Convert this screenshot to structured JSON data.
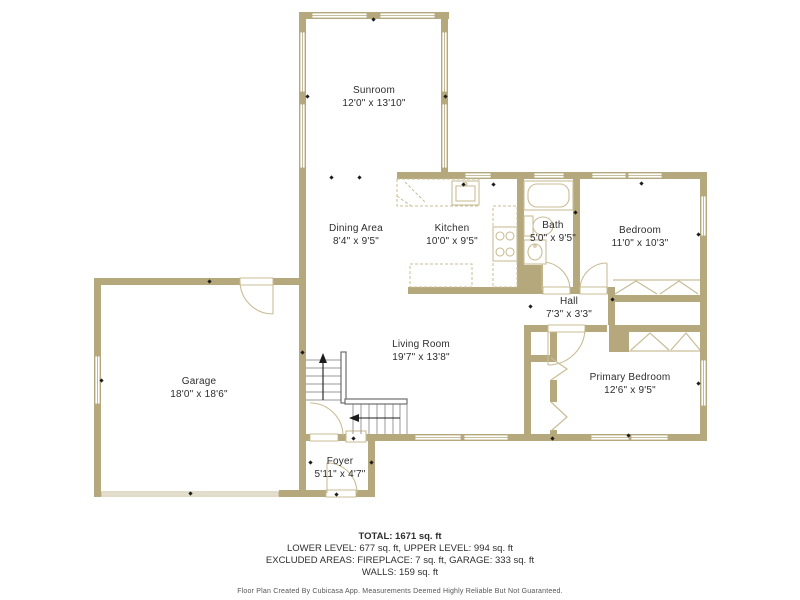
{
  "plan": {
    "wall_color": "#b5a87c",
    "fixture_line_color": "#c9bd97",
    "rooms": [
      {
        "id": "sunroom",
        "name": "Sunroom",
        "dims": "12'0\" x 13'10\""
      },
      {
        "id": "dining-area",
        "name": "Dining Area",
        "dims": "8'4\" x 9'5\""
      },
      {
        "id": "kitchen",
        "name": "Kitchen",
        "dims": "10'0\" x 9'5\""
      },
      {
        "id": "bath",
        "name": "Bath",
        "dims": "5'0\" x 9'5\""
      },
      {
        "id": "bedroom",
        "name": "Bedroom",
        "dims": "11'0\" x 10'3\""
      },
      {
        "id": "hall",
        "name": "Hall",
        "dims": "7'3\" x 3'3\""
      },
      {
        "id": "living-room",
        "name": "Living Room",
        "dims": "19'7\" x 13'8\""
      },
      {
        "id": "garage",
        "name": "Garage",
        "dims": "18'0\" x 18'6\""
      },
      {
        "id": "primary-bedroom",
        "name": "Primary Bedroom",
        "dims": "12'6\" x 9'5\""
      },
      {
        "id": "foyer",
        "name": "Foyer",
        "dims": "5'11\" x 4'7\""
      }
    ]
  },
  "footer": {
    "total": "TOTAL: 1671 sq. ft",
    "levels": "LOWER LEVEL: 677 sq. ft, UPPER LEVEL: 994 sq. ft",
    "excluded": "EXCLUDED AREAS: FIREPLACE: 7 sq. ft, GARAGE: 333 sq. ft",
    "walls": "WALLS: 159 sq. ft",
    "disclaimer": "Floor Plan Created By Cubicasa App. Measurements Deemed Highly Reliable But Not Guaranteed."
  }
}
